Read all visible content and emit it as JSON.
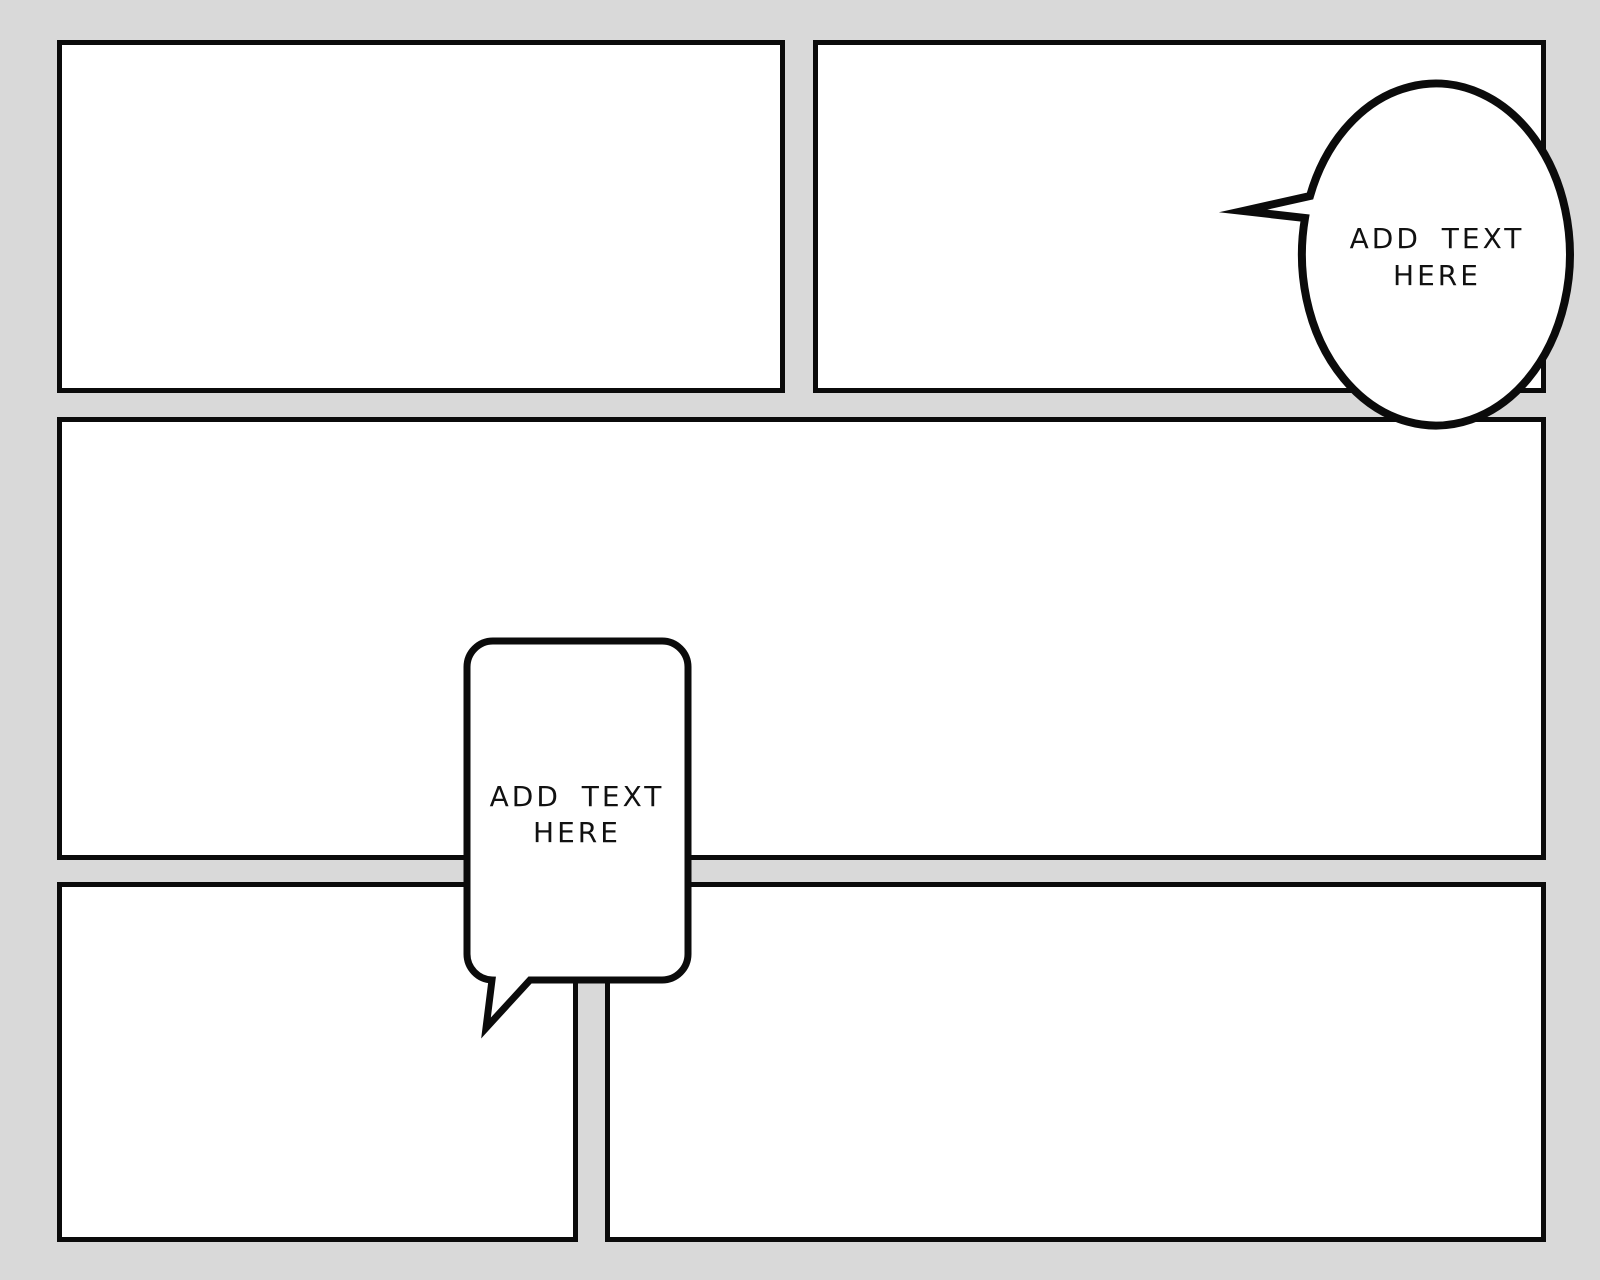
{
  "canvas": {
    "background_color": "#d9d9d9",
    "panel_fill_color": "#ffffff",
    "ink_color": "#0b0b0b"
  },
  "panels": {
    "count": 5,
    "layout": "comic-strip-grid"
  },
  "speech_bubbles": {
    "oval": {
      "shape": "oval",
      "line1": "ADD TEXT",
      "line2": "HERE"
    },
    "rounded_rect": {
      "shape": "rounded-rectangle",
      "line1": "ADD TEXT",
      "line2": "HERE"
    }
  }
}
